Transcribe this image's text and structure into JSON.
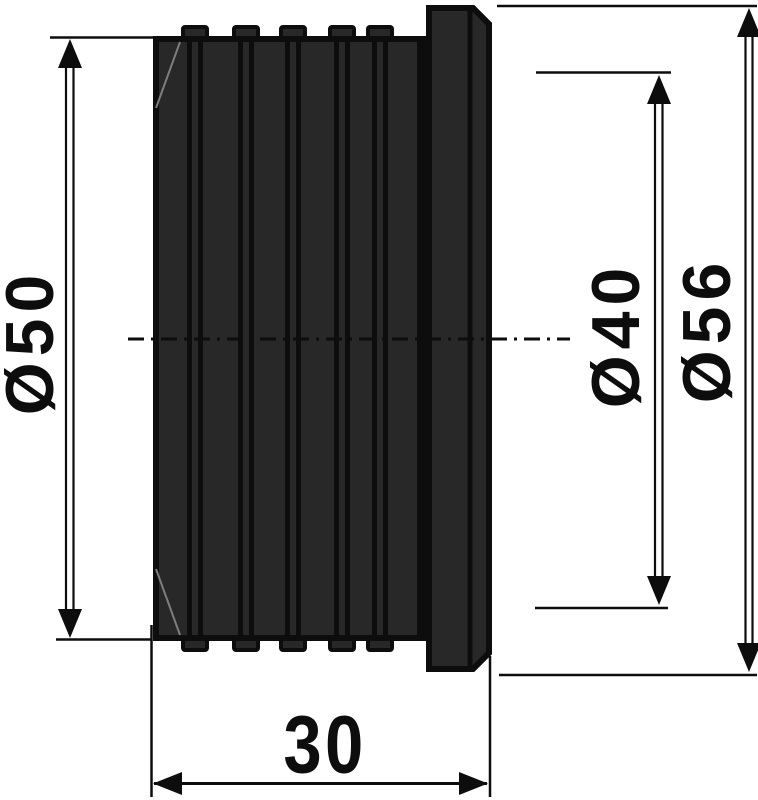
{
  "drawing": {
    "type": "technical-dimension-drawing",
    "part": "ribbed-reducer-side-view",
    "colors": {
      "background": "#ffffff",
      "line": "#0d0d0d",
      "body_fill": "#282828",
      "chamfer_highlight": "#7d7d7d"
    },
    "dimensions": {
      "diameter_body": {
        "label": "Ø50",
        "orientation": "vertical-left"
      },
      "diameter_inner": {
        "label": "Ø40",
        "orientation": "vertical-right"
      },
      "diameter_flange": {
        "label": "Ø56",
        "orientation": "vertical-far-right"
      },
      "length": {
        "label": "30",
        "orientation": "horizontal-bottom"
      }
    }
  }
}
